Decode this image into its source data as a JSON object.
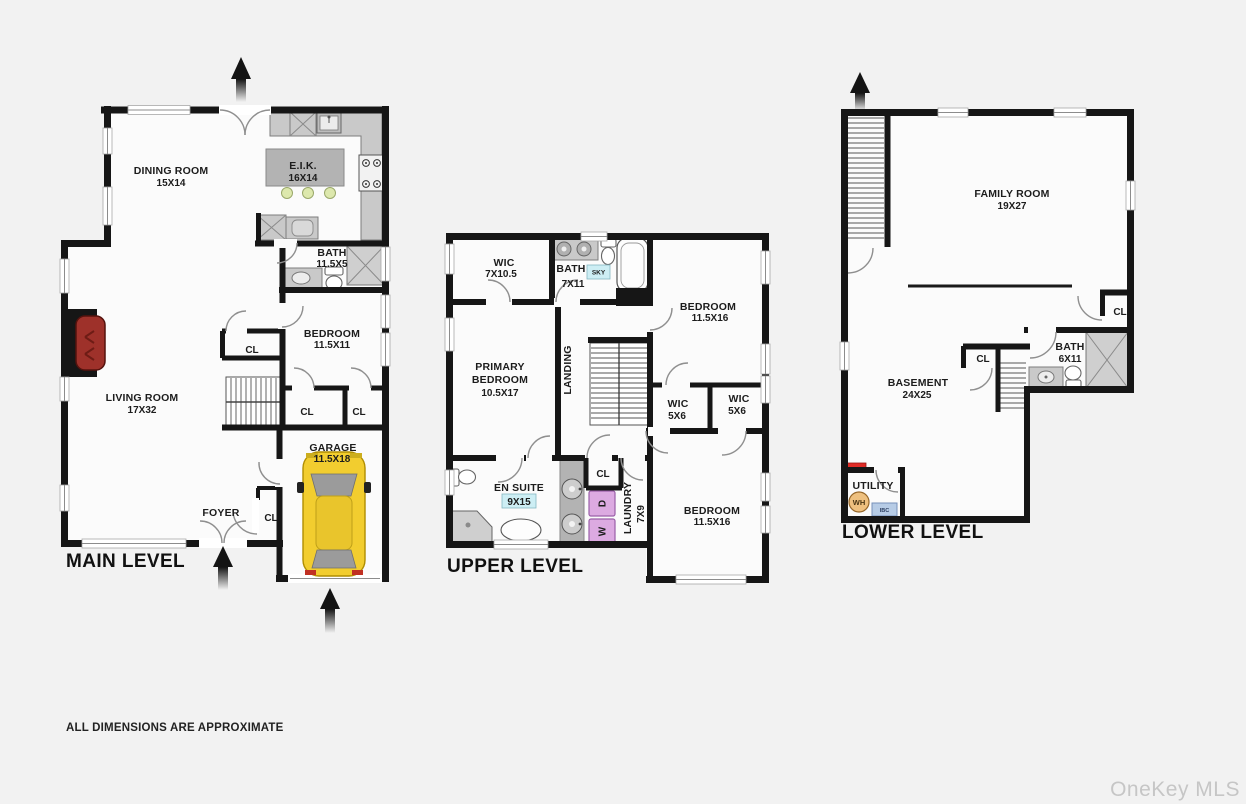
{
  "meta": {
    "watermark": "OneKey MLS",
    "disclaimer": "ALL DIMENSIONS ARE APPROXIMATE"
  },
  "colors": {
    "background": "#f2f2f2",
    "floor": "#fbfbfb",
    "wall": "#161616",
    "car_yellow": "#f2cd2f",
    "car_roof_yellow": "#e9c52c",
    "fireplace_red": "#9e312a",
    "laundry_purple": "#dcaae1",
    "water_heater_tan": "#eec07f",
    "boiler_blue": "#b7cce6",
    "skylight_cyan": "#cdeef4",
    "panel_red": "#df2b26",
    "pendant_green": "#dde8ad",
    "watermark_gray": "#c6c6c6"
  },
  "main": {
    "title": "MAIN LEVEL",
    "dining_name": "DINING ROOM",
    "dining_dims": "15X14",
    "eik_name": "E.I.K.",
    "eik_dims": "16X14",
    "bath_name": "BATH",
    "bath_dims": "11.5X5",
    "bedroom_name": "BEDROOM",
    "bedroom_dims": "11.5X11",
    "living_name": "LIVING ROOM",
    "living_dims": "17X32",
    "garage_name": "GARAGE",
    "garage_dims": "11.5X18",
    "foyer_name": "FOYER",
    "cl_hall": "CL",
    "cl_bed1": "CL",
    "cl_bed2": "CL",
    "cl_foyer": "CL"
  },
  "upper": {
    "title": "UPPER LEVEL",
    "wic_name": "WIC",
    "wic_dims": "7X10.5",
    "bath_name": "BATH",
    "bath_dims": "7X11",
    "sky": "SKY",
    "bed1_name": "BEDROOM",
    "bed1_dims": "11.5X16",
    "primary_l1": "PRIMARY",
    "primary_l2": "BEDROOM",
    "primary_dims": "10.5X17",
    "landing": "LANDING",
    "wic1_name": "WIC",
    "wic1_dims": "5X6",
    "wic2_name": "WIC",
    "wic2_dims": "5X6",
    "ensuite_name": "EN SUITE",
    "ensuite_dims": "9X15",
    "cl": "CL",
    "dryer": "D",
    "washer": "W",
    "laundry_name": "LAUNDRY",
    "laundry_dims": "7X9",
    "bed2_name": "BEDROOM",
    "bed2_dims": "11.5X16"
  },
  "lower": {
    "title": "LOWER LEVEL",
    "family_name": "FAMILY ROOM",
    "family_dims": "19X27",
    "cl1": "CL",
    "bath_name": "BATH",
    "bath_dims": "6X11",
    "cl2": "CL",
    "basement_name": "BASEMENT",
    "basement_dims": "24X25",
    "utility_name": "UTILITY",
    "wh": "WH",
    "ibc": "IBC"
  }
}
